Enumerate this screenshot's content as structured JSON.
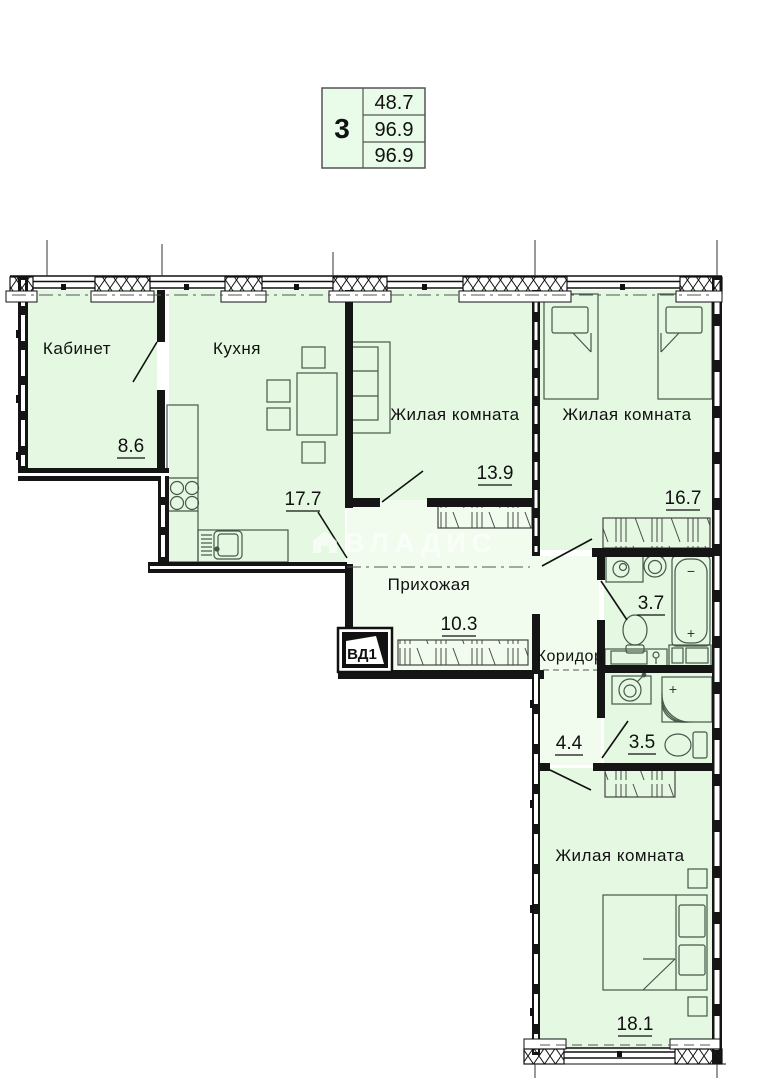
{
  "legend": {
    "rooms_count": "3",
    "row1": "48.7",
    "row2": "96.9",
    "row3": "96.9"
  },
  "watermark": "ВЛАДИС",
  "vent_label": "ВД1",
  "rooms": {
    "kabinet": {
      "name": "Кабинет",
      "area": "8.6"
    },
    "kitchen": {
      "name": "Кухня",
      "area": "17.7"
    },
    "living1": {
      "name": "Жилая комната",
      "area": "13.9"
    },
    "living2": {
      "name": "Жилая комната",
      "area": "16.7"
    },
    "hallway": {
      "name": "Прихожая",
      "area": "10.3"
    },
    "corridor": {
      "name": "Коридор",
      "area": "4.4"
    },
    "bathroom": {
      "area": "3.7"
    },
    "shower_room": {
      "area": "3.5"
    },
    "living3": {
      "name": "Жилая комната",
      "area": "18.1"
    }
  },
  "symbols": {
    "plus": "+",
    "minus": "−"
  },
  "colors": {
    "room_fill": "#e4f8e2",
    "hall_fill": "#f1fcee",
    "legend_fill": "#e9fce9",
    "wall": "#151515",
    "furniture_stroke": "#45584a"
  }
}
